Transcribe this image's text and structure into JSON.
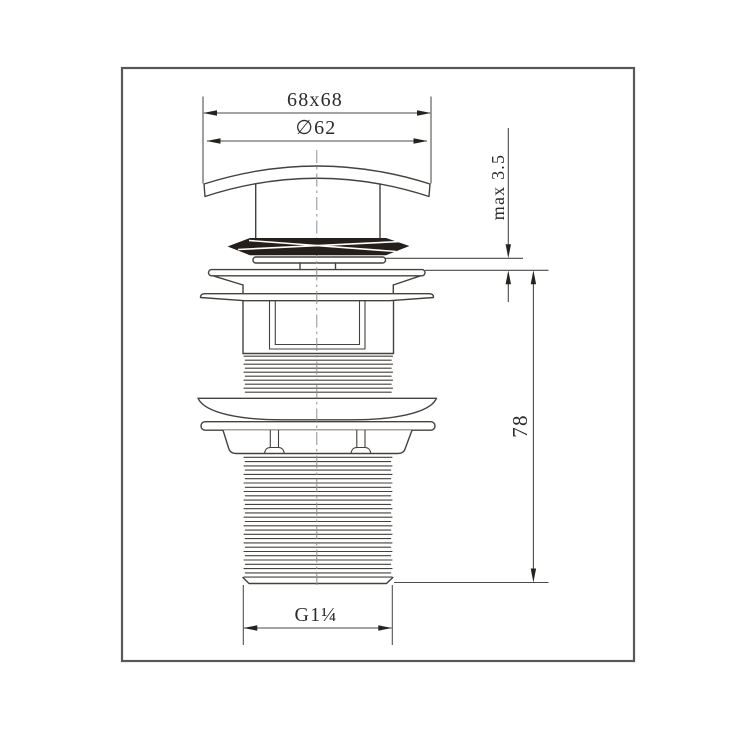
{
  "drawing": {
    "type": "technical-drawing",
    "subject": "pop-up basin waste fitting, side elevation",
    "colors": {
      "background": "#ffffff",
      "frame": "#58585a",
      "line": "#45413c",
      "seal_fill": "#251f1b",
      "centerline": "#8f8f8f",
      "text": "#2d2b29"
    },
    "dimensions": {
      "top_width": "68x68",
      "cap_diameter": "∅62",
      "max_thickness": "max 3.5",
      "body_height": "78",
      "thread_size": "G1¼"
    }
  }
}
